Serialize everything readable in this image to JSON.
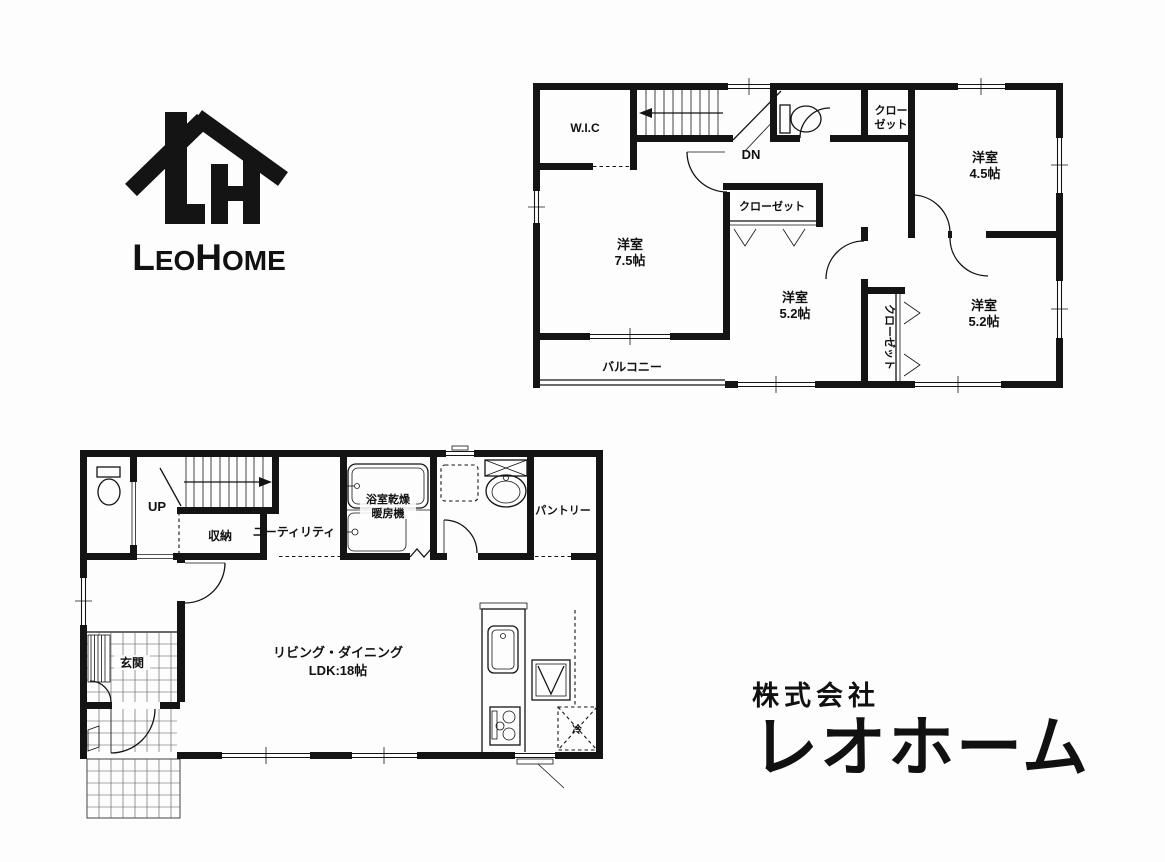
{
  "logo": {
    "parts": [
      "L",
      "EO",
      "H",
      "OME"
    ]
  },
  "company": {
    "prefix": "株式会社",
    "name": "レオホーム"
  },
  "floor2": {
    "labels": {
      "wic": "W.I.C",
      "dn": "DN",
      "closet_top_line1": "クロー",
      "closet_top_line2": "ゼット",
      "room45_line1": "洋室",
      "room45_line2": "4.5帖",
      "room75_line1": "洋室",
      "room75_line2": "7.5帖",
      "closet_mid": "クローゼット",
      "room52_center_line1": "洋室",
      "room52_center_line2": "5.2帖",
      "closet_side": "クローゼット",
      "room52_right_line1": "洋室",
      "room52_right_line2": "5.2帖",
      "balcony": "バルコニー"
    }
  },
  "floor1": {
    "labels": {
      "up": "UP",
      "storage": "収納",
      "utility": "ユーティリティ",
      "bath_line1": "浴室乾燥",
      "bath_line2": "暖房機",
      "pantry": "パントリー",
      "entrance": "玄関",
      "ldk_line1": "リビング・ダイニング",
      "ldk_line2": "LDK:18帖",
      "fridge": "冷"
    }
  }
}
